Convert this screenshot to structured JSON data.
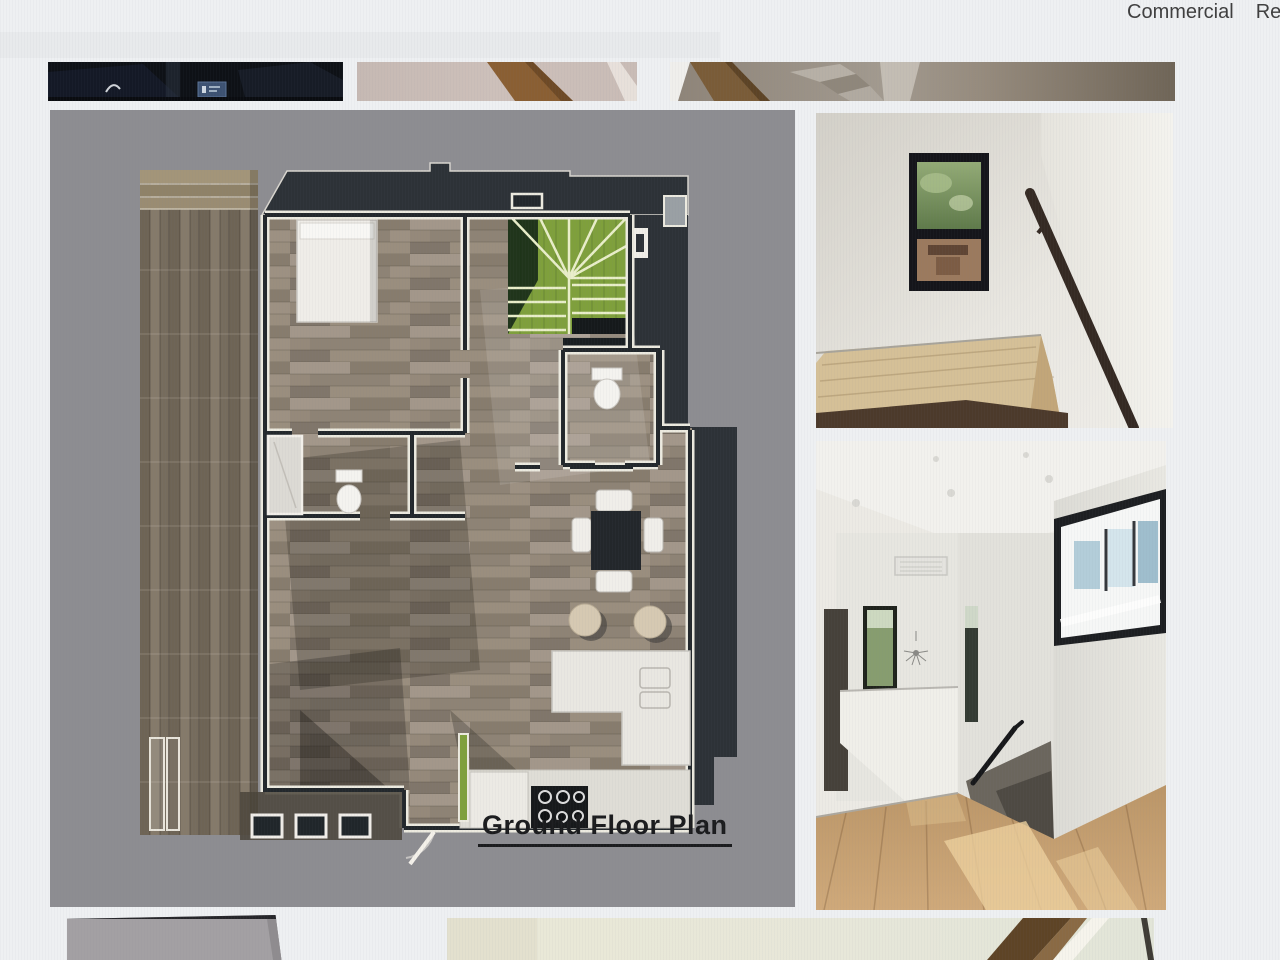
{
  "nav": {
    "items": [
      {
        "label": "Commercial"
      },
      {
        "label": "Res"
      }
    ]
  },
  "plan": {
    "caption": "Ground Floor Plan",
    "alt": "3D rendered ground floor plan on gray background"
  },
  "gallery": {
    "top_thumbnails": [
      {
        "alt": "dark interior photo (bottom sliver)"
      },
      {
        "alt": "beige wall with wood beam (bottom sliver)"
      },
      {
        "alt": "staircase close-up (bottom sliver)"
      }
    ],
    "side_photos": [
      {
        "alt": "stair landing with black framed window and wood handrail"
      },
      {
        "alt": "upstairs hallway with oak floor, stair opening and clerestory window"
      }
    ],
    "bottom_partials": [
      {
        "alt": "gray wall corner (top sliver)"
      },
      {
        "alt": "pale room with dark stair stringer (top sliver)"
      }
    ]
  },
  "theme": {
    "page_bg": "#eef0f2",
    "nav_text": "#3f3f3f",
    "plan_bg": "#8d8d91",
    "wall_dark": "#2d3237",
    "accent_green": "#7fa03c",
    "wood_floor": "#95897a",
    "deck_wood": "#7b7162",
    "caption_color": "#1b1c1e"
  }
}
